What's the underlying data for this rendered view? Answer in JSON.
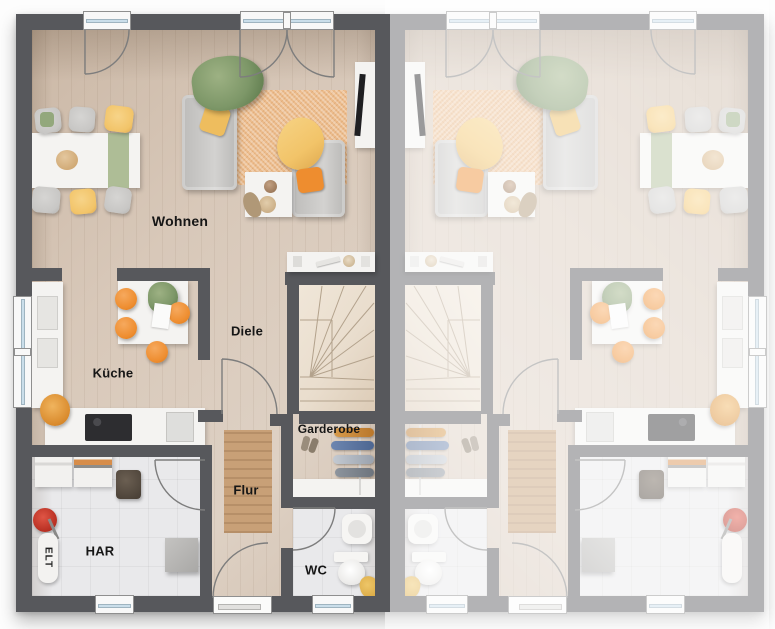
{
  "plan": {
    "type": "floor-plan",
    "rooms": [
      {
        "id": "wohnen",
        "label": "Wohnen"
      },
      {
        "id": "kueche",
        "label": "Küche"
      },
      {
        "id": "diele",
        "label": "Diele"
      },
      {
        "id": "garderobe",
        "label": "Garderobe"
      },
      {
        "id": "flur",
        "label": "Flur"
      },
      {
        "id": "har",
        "label": "HAR"
      },
      {
        "id": "wc",
        "label": "WC"
      },
      {
        "id": "elt",
        "label": "ELT"
      }
    ],
    "units": [
      {
        "id": "unit-left",
        "mirrored": false,
        "labels_visible": true
      },
      {
        "id": "unit-right",
        "mirrored": true,
        "labels_visible": false
      }
    ],
    "colors": {
      "wall": "#57585c",
      "wood": "#d8c8b9",
      "tile": "#e9e9eb",
      "stairs": "#e9ddcd",
      "rug": "#ecbc8c",
      "runner": "#c8a077",
      "orange": "#ee8d2f",
      "yellow": "#f2c469",
      "green": "#7d9768",
      "sofa": "#c8c7c5",
      "glass": "#cadeea",
      "fade": "rgba(255,255,255,0.55)",
      "label": "#161616"
    }
  }
}
